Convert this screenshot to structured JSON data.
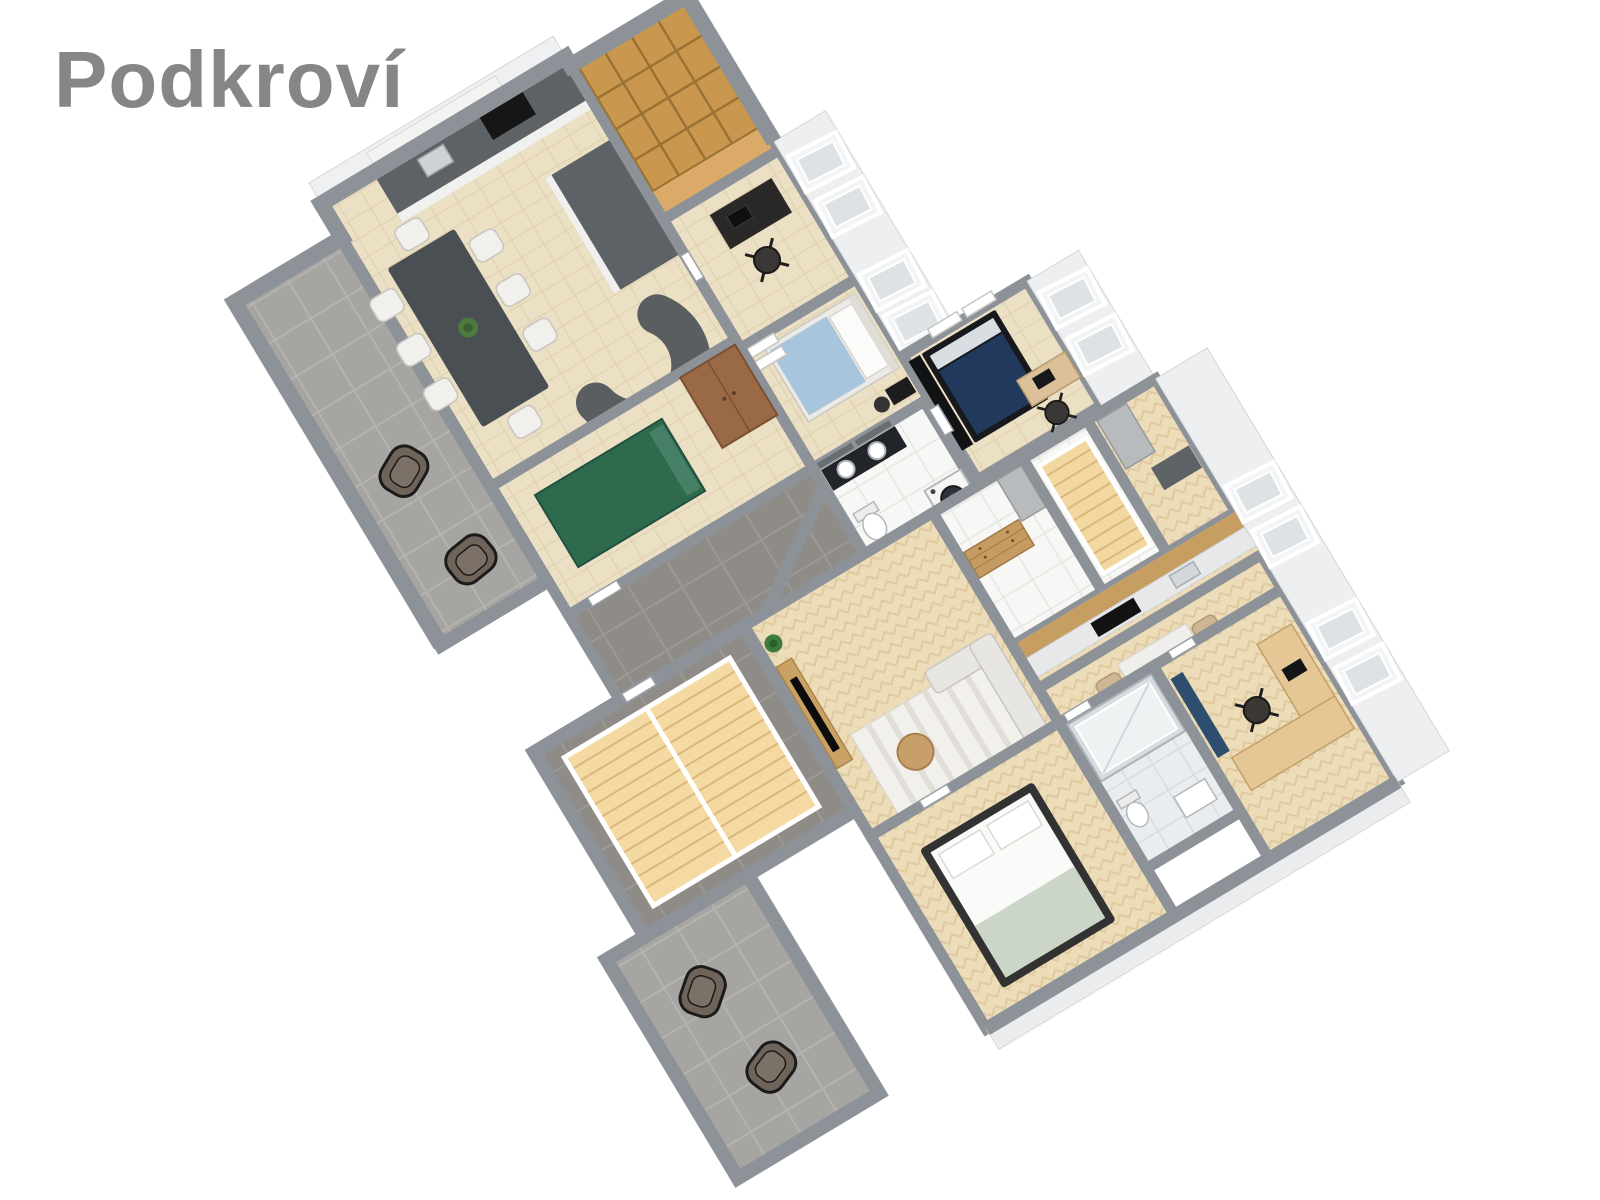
{
  "title": "Podkroví",
  "page": {
    "background": "#ffffff"
  },
  "floor_plan": {
    "style": "3d-isometric-floor-plan",
    "rotation_deg": -31,
    "palette": {
      "title_color": "#868686",
      "wall": "#8c9298",
      "wood_floor": "#ebdfc4",
      "herringbone_floor": "#eddcb8",
      "terrace_tile": "#a7a5a2",
      "dark_tile": "#8f8c88",
      "white_tile": "#f7f7f5",
      "bath_tile": "#e9edef",
      "shelf_room_floor": "#dcaa68",
      "bookshelf": "#c9984e",
      "roof_band": "#edeff1",
      "counter_dark": "#5d6266",
      "sofa_gray": "#5a5e61",
      "bed_green": "#2e6a4d",
      "bed_navy": "#20395c",
      "bed_light_blue": "#a9c4dd",
      "big_bed_frame": "#323232",
      "blanket_sage": "#ccd6c8",
      "wardrobe_brown": "#9a6a47",
      "stairs_wood": "#f5d9a2",
      "desk_wood": "#e4c795",
      "dresser_wood": "#c59b63",
      "rug_stripes": "#f2f0ea",
      "runner_blue": "#2d4e6e",
      "plant_green": "#3c7a3e"
    },
    "left_apartment": {
      "rooms": [
        {
          "name": "terrace",
          "floor": "gray-tile",
          "furniture": [
            "lounge-chair",
            "lounge-chair"
          ]
        },
        {
          "name": "kitchen-living-room",
          "floor": "light-wood",
          "furniture": [
            "kitchen-counter",
            "cooktop",
            "sink",
            "kitchen-island",
            "hood-cabinet",
            "dark-dining-table",
            "eight-white-chairs",
            "table-plant",
            "curved-gray-sofa"
          ]
        },
        {
          "name": "storage-room",
          "floor": "tan-wood",
          "furniture": [
            "cell-bookshelf"
          ]
        },
        {
          "name": "study",
          "floor": "light-wood",
          "furniture": [
            "dark-desk",
            "office-chair",
            "laptop"
          ],
          "skylights": 2
        },
        {
          "name": "bedroom-blue",
          "floor": "light-wood",
          "furniture": [
            "light-blue-bed",
            "wall-shelves",
            "small-desk",
            "chair"
          ],
          "skylights": 2
        },
        {
          "name": "bathroom",
          "floor": "white-tile",
          "furniture": [
            "double-sink-vanity",
            "mirrors",
            "washing-machine",
            "toilet"
          ]
        },
        {
          "name": "bedroom-green",
          "floor": "light-wood",
          "furniture": [
            "green-bed",
            "brown-wardrobe"
          ]
        },
        {
          "name": "hallway",
          "floor": "dark-tile",
          "furniture": [
            "door"
          ]
        },
        {
          "name": "staircase-room",
          "floor": "dark-tile",
          "furniture": [
            "wooden-staircase",
            "white-railing"
          ]
        }
      ]
    },
    "right_apartment": {
      "rooms": [
        {
          "name": "bedroom-navy",
          "floor": "light-wood",
          "furniture": [
            "navy-bed",
            "black-wardrobe",
            "wood-desk",
            "office-chair",
            "laptop",
            "wall-shelves"
          ],
          "skylights": 2
        },
        {
          "name": "wc",
          "floor": "white-tile",
          "furniture": [
            "toilet",
            "small-sink"
          ]
        },
        {
          "name": "hallway",
          "floor": "white-tile",
          "furniture": [
            "wooden-dresser",
            "tall-gray-cabinet"
          ]
        },
        {
          "name": "staircase",
          "floor": "white-tile",
          "furniture": [
            "wooden-stairs",
            "white-railing"
          ]
        },
        {
          "name": "kitchen",
          "floor": "herringbone-wood",
          "furniture": [
            "kitchen-counter",
            "cooktop",
            "sink",
            "tall-gray-cabinet"
          ],
          "skylights": 2
        },
        {
          "name": "dining-area",
          "floor": "herringbone-wood",
          "furniture": [
            "white-dining-table",
            "four-beige-chairs",
            "vase"
          ]
        },
        {
          "name": "living-area",
          "floor": "herringbone-wood",
          "furniture": [
            "tv-sideboard",
            "tv",
            "plant",
            "striped-rug",
            "round-coffee-table",
            "light-corner-sofa"
          ]
        },
        {
          "name": "bedroom-main",
          "floor": "herringbone-wood",
          "furniture": [
            "dark-frame-bed",
            "white-bedding",
            "sage-blanket",
            "pillows"
          ]
        },
        {
          "name": "bathroom",
          "floor": "gray-marble-tile",
          "furniture": [
            "glass-shower",
            "toilet",
            "sink"
          ]
        },
        {
          "name": "home-office",
          "floor": "herringbone-wood",
          "furniture": [
            "l-shaped-wood-desk",
            "office-chair",
            "laptop",
            "blue-runner-rug"
          ],
          "skylights": 2
        },
        {
          "name": "terrace",
          "floor": "gray-tile",
          "furniture": [
            "lounge-chair",
            "lounge-chair"
          ]
        }
      ]
    }
  }
}
